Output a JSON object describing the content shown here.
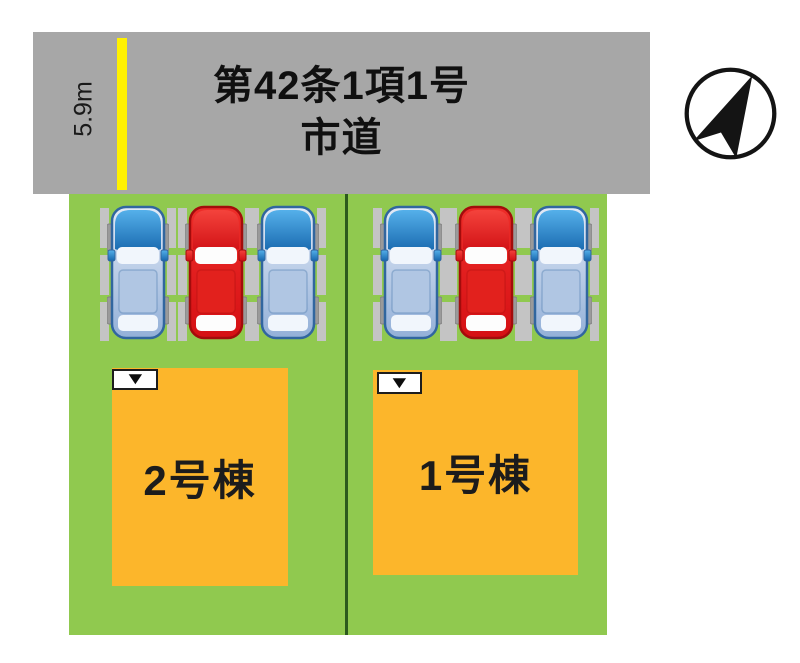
{
  "road": {
    "name_line1": "第42条1項1号",
    "name_line2": "市道",
    "width_label": "5.9m",
    "surface_color": "#a7a7a7",
    "edge_line_color": "#fff100"
  },
  "compass": {
    "label": "north-arrow",
    "color": "#141414"
  },
  "site": {
    "ground_color": "#90c94f",
    "divider_color": "#2c5a1d",
    "building_color": "#fcb62b",
    "entrance_marker": "▼",
    "plots": [
      {
        "id": "plot-2",
        "building_label": "2号棟",
        "cars": [
          "blue",
          "red",
          "blue"
        ]
      },
      {
        "id": "plot-1",
        "building_label": "1号棟",
        "cars": [
          "blue",
          "red",
          "blue"
        ]
      }
    ]
  },
  "car_colors": {
    "blue": {
      "roof": "#b0c6e3",
      "window": "#f1f6fc",
      "outline": "#31669f",
      "wheel": "#9a9a9a"
    },
    "red": {
      "roof": "#e2211d",
      "window": "#fdfdfd",
      "outline": "#a30c0c",
      "wheel": "#9a9a9a"
    }
  }
}
